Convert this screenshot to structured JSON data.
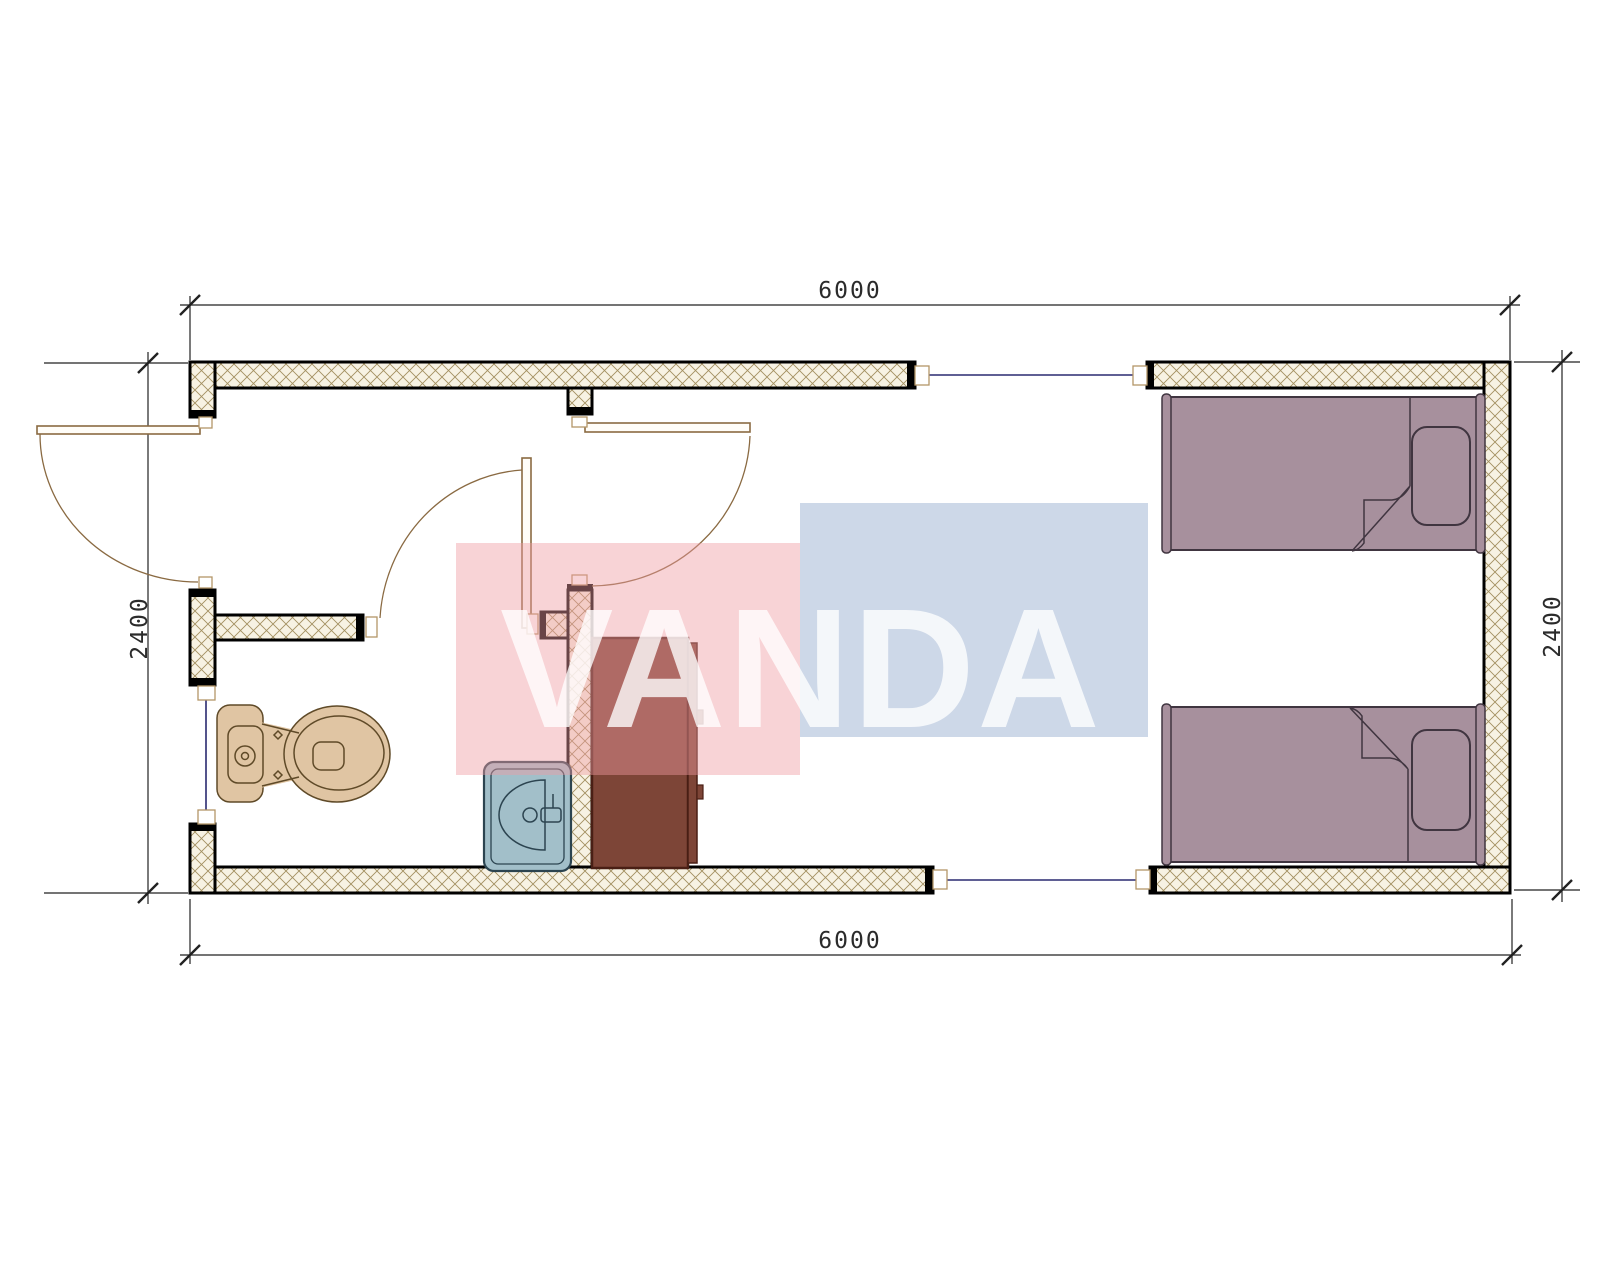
{
  "drawing": {
    "type": "floor-plan",
    "unit_hint": "mm"
  },
  "dimensions": {
    "top_width": "6000",
    "bottom_width": "6000",
    "left_height": "2400",
    "right_height": "2400"
  },
  "watermark": {
    "text": "VANDA",
    "pink_fill": "rgba(239,155,162,0.44)",
    "blue_fill": "rgba(155,177,209,0.5)",
    "text_fill": "rgba(255,255,255,0.78)"
  },
  "palette": {
    "background": "#ffffff",
    "wall_hatch_bg": "#f7f2e3",
    "wall_hatch_line": "#a39060",
    "wall_outline": "#000000",
    "window_glass": "#2a2a70",
    "door_line": "#8a6a42",
    "frame_line": "#b49668",
    "frame_fill": "#ffffff",
    "door_leaf_fill": "#fffdf8",
    "toilet_fill": "#e0c5a3",
    "toilet_line": "#5f4a28",
    "sink_fill": "#a2bfc9",
    "sink_line": "#2c4450",
    "wardrobe_fill": "#7d4537",
    "wardrobe_line": "#491f15",
    "bed_fill": "#a7909d",
    "bed_line": "#403540",
    "dim_line": "#222222",
    "dim_text": "#2b2b2b"
  }
}
